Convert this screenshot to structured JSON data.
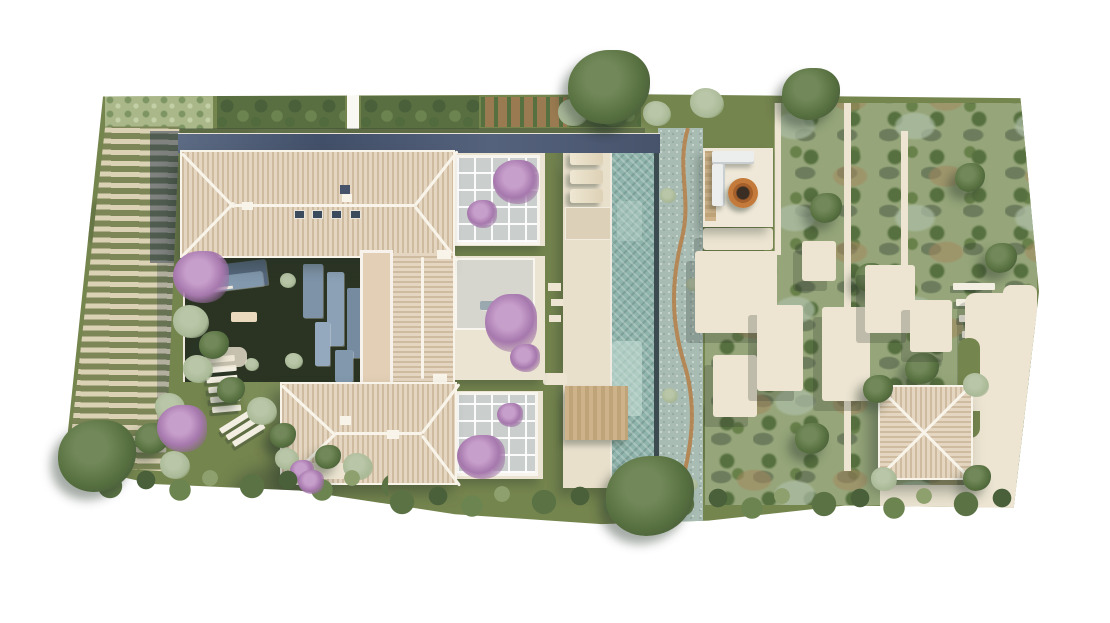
{
  "scene": {
    "type": "aerial-site-plan-rendering",
    "description": "Top-down photorealistic 3D rendering of a Mediterranean villa estate: U-shaped house with beige hip tile roofs around a shaded courtyard, flat dark roof strip, three bougainvillea pergolas, a long rectangular pool with sun loungers and timber deck, fire-pit lounge with L-shaped sofa, dry creek gravel bed, striped vineyard/lavender field on the left, olive-tree grove with winding stone paths, steps, a square pavilion and a driveway on the right, hedges framing top and bottom edges on a white background.",
    "background": "#ffffff",
    "visible_text": []
  },
  "palette": {
    "lawn": "#75854e",
    "vine-row": "#7c8656",
    "vine-gap": "#dbd2b6",
    "tile-a": "#cfbb9f",
    "tile-b": "#e4d6c1",
    "ridge": "#f8f4ea",
    "dark-roof": "#47536b",
    "dark-roof-lt": "#5d6b84",
    "court": "#2b3423",
    "panel": "#8298ad",
    "panel-dk": "#55677d",
    "flatroof": "#e2cfb5",
    "terrace": "#ece4d2",
    "purple": "#a678ad",
    "deck": "#e9e0cc",
    "slab": "#dcd0b8",
    "pool": "#8fb4ab",
    "pool-light": "#c6ddd5",
    "pool-edge": "#3c4b4f",
    "wood": "#c6ab83",
    "creek": "#a9bcb4",
    "creek-line": "#b5793f",
    "patio": "#efe8d8",
    "path": "#ede5d2",
    "sofa": "#eceeee",
    "firepit": "#b96f34",
    "grove": "#96a67a",
    "tree": "#57703f",
    "tree-lt": "#68804a",
    "sage": "#a9b996",
    "soil": "#9a7a50",
    "step": "#f3eee2"
  },
  "elements": {
    "house": {
      "wings": 3,
      "roof_type": "hip, barrel tile",
      "skylights": 4,
      "chimneys": 4,
      "courtyard": "dark shaded floor with grey glass panels and bench",
      "flat_roof_walkway": 1
    },
    "pool": {
      "shape": "long rectangle",
      "loungers": 3,
      "timber_deck": 1,
      "tanning_ledge": 1
    },
    "fire_pit_lounge": {
      "sofa": "L-shaped white",
      "fire_pit": "round copper",
      "deck_strip": "timber"
    },
    "pergolas": {
      "count": 3,
      "planting": "purple bougainvillea"
    },
    "vineyard_field": {
      "pattern": "diagonal green rows on cream soil",
      "house_shadow": true
    },
    "kitchen_garden": {
      "sections": 5,
      "location": "top edge"
    },
    "olive_grove": {
      "location": "right half",
      "paths": "white stone cuts",
      "tree_grid": true
    },
    "stone_paths": {
      "style": "stepped-edge cream slabs with long cast shadows"
    },
    "steps": {
      "flights": 3
    },
    "pavilion": {
      "roof": "pyramidal tile with white X ridges"
    },
    "driveway": {
      "location": "right edge"
    },
    "hedgerow": {
      "location": "bottom edge"
    },
    "feature_trees": {
      "green": 4,
      "purple_flowering": 4
    }
  }
}
